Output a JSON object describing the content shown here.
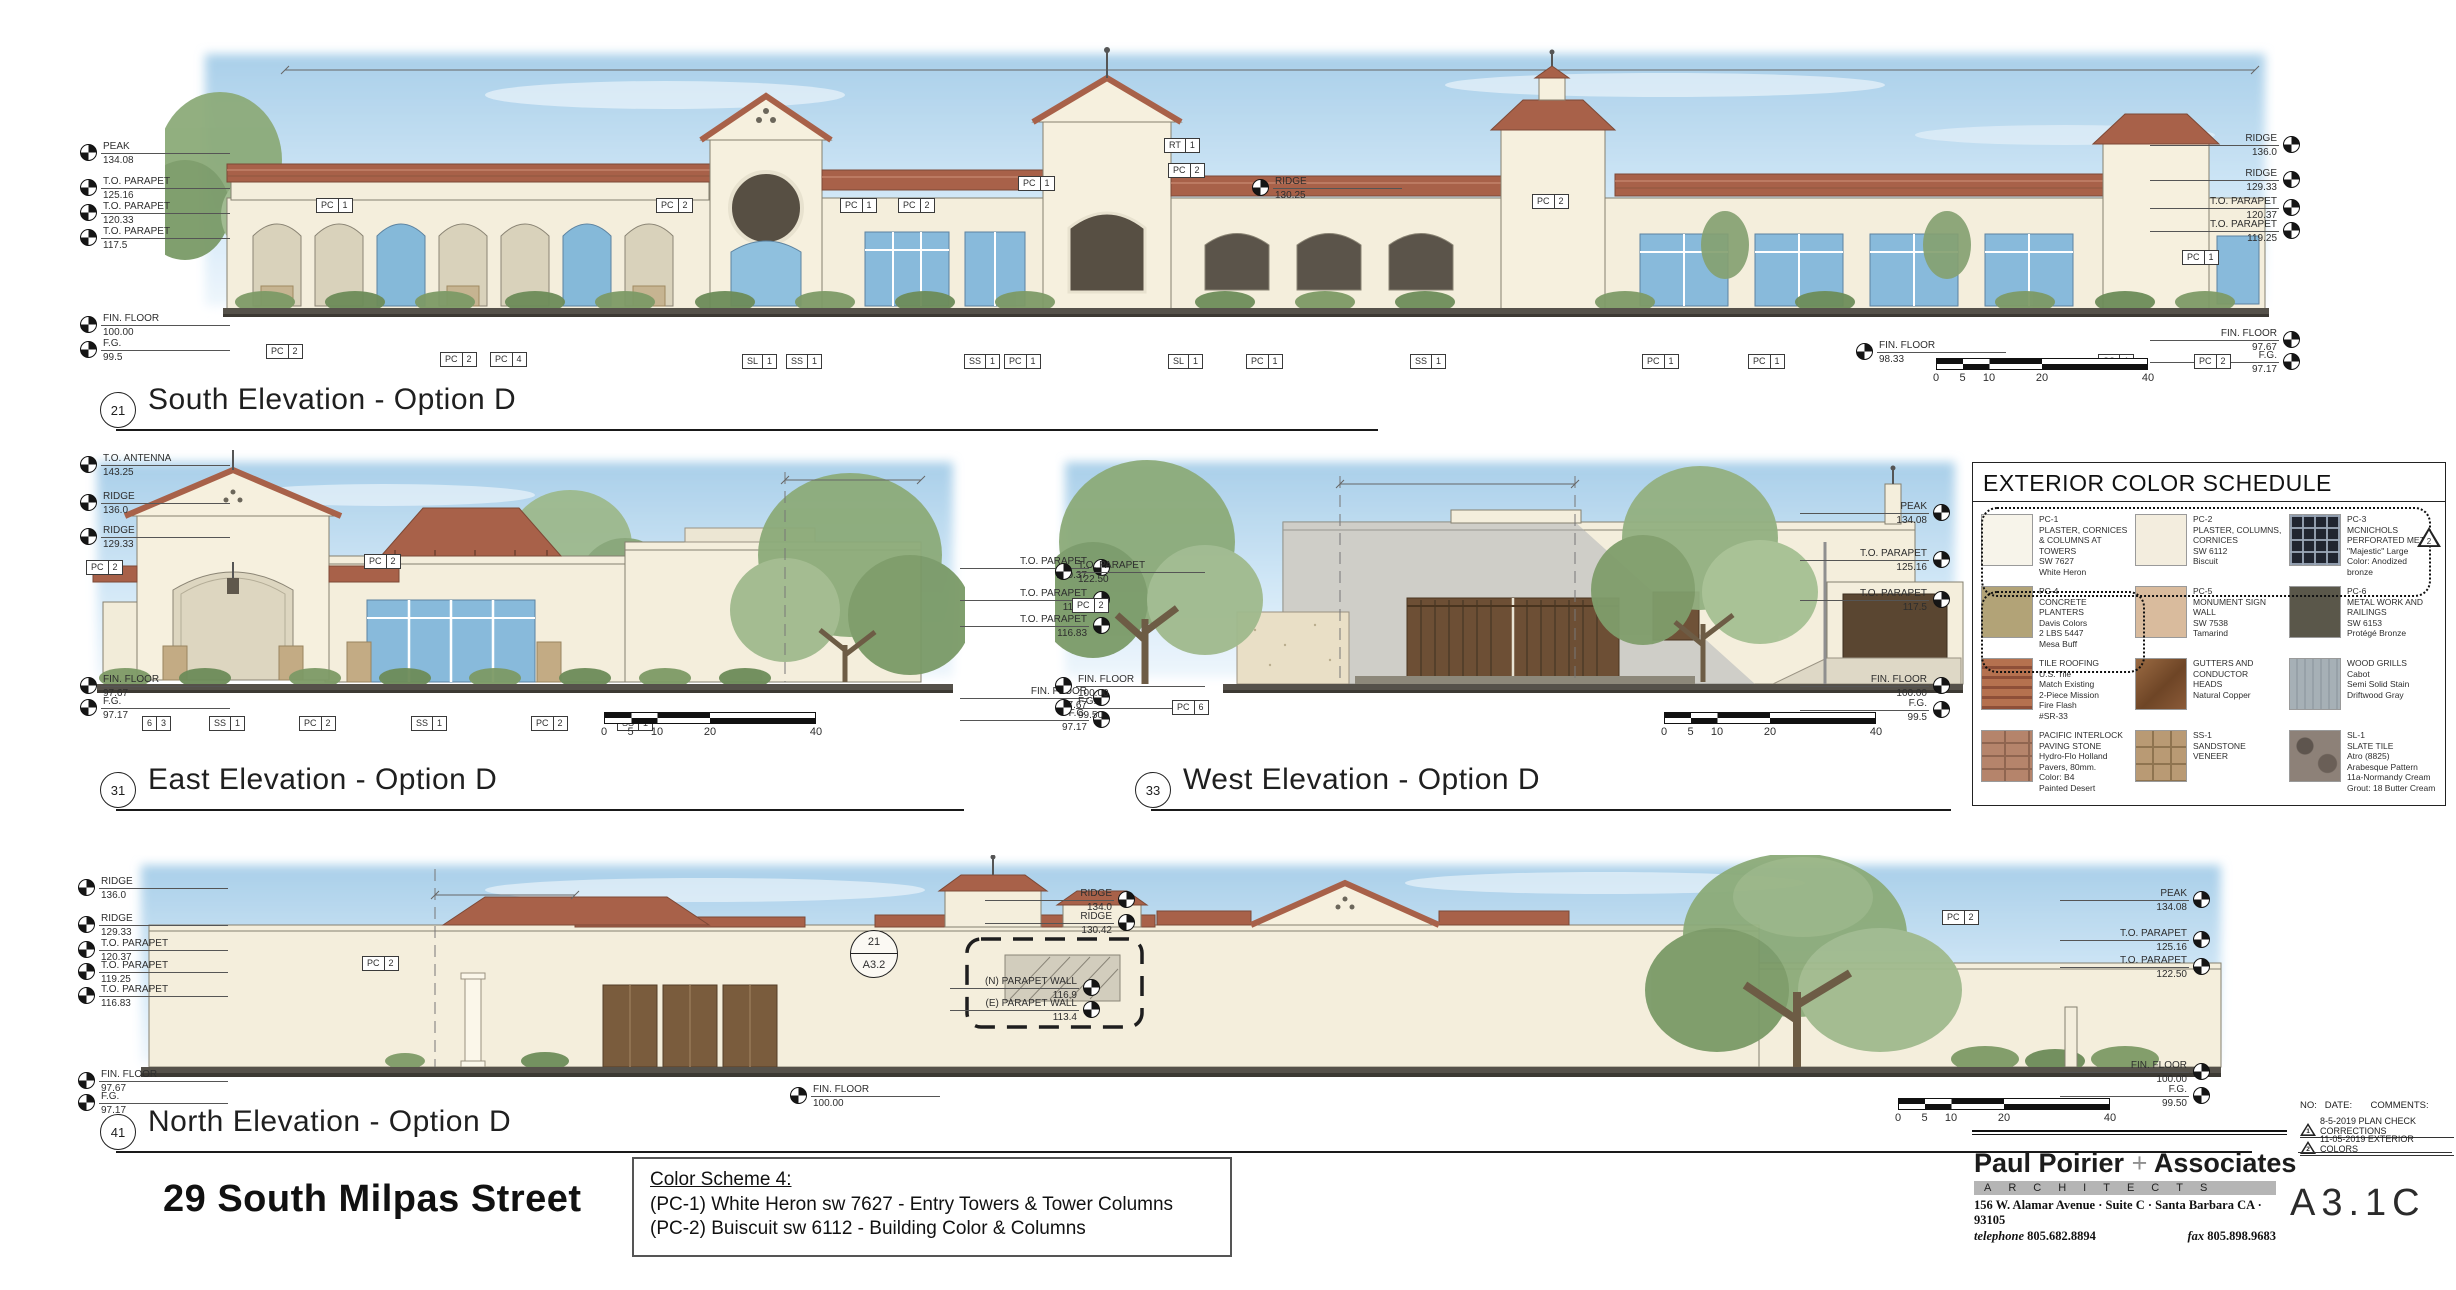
{
  "sheet": {
    "project_title": "29 South Milpas Street",
    "sheet_no": "A3.1C",
    "color_note": {
      "heading": "Color Scheme 4:",
      "line1": "(PC-1) White Heron sw 7627 - Entry Towers & Tower Columns",
      "line2": "(PC-2) Buiscuit sw 6112 - Building Color & Columns"
    },
    "firm": {
      "name_a": "Paul Poirier ",
      "plus": "+",
      "name_b": " Associates",
      "band": "ARCHITECTS",
      "address": "156 W. Alamar Avenue · Suite C · Santa Barbara CA · 93105",
      "tel_label": "telephone ",
      "tel": "805.682.8894",
      "fax_label": "fax ",
      "fax": "805.898.9683"
    },
    "revisions_header": "NO:   DATE:       COMMENTS:",
    "revisions": [
      {
        "no": "1",
        "text": "8-5-2019 PLAN CHECK CORRECTIONS",
        "x": 2300,
        "y": 1116
      },
      {
        "no": "2",
        "text": "11-05-2019 EXTERIOR COLORS",
        "x": 2300,
        "y": 1134
      }
    ],
    "schedule_delta": "2"
  },
  "titles": [
    {
      "text": "South Elevation - Option D",
      "bubble": "21",
      "x": 100,
      "y": 372,
      "lw": 1262
    },
    {
      "text": "East Elevation - Option D",
      "bubble": "31",
      "x": 100,
      "y": 752,
      "lw": 848
    },
    {
      "text": "West Elevation - Option D",
      "bubble": "33",
      "x": 1135,
      "y": 752,
      "lw": 800
    },
    {
      "text": "North Elevation - Option D",
      "bubble": "41",
      "x": 100,
      "y": 1094,
      "lw": 2136
    }
  ],
  "scalebars": [
    {
      "x": 1936,
      "y": 358,
      "t0": "0",
      "t1": "5",
      "t2": "10",
      "t3": "20",
      "t4": "40"
    },
    {
      "x": 604,
      "y": 712,
      "t0": "0",
      "t1": "5",
      "t2": "10",
      "t3": "20",
      "t4": "40"
    },
    {
      "x": 1664,
      "y": 712,
      "t0": "0",
      "t1": "5",
      "t2": "10",
      "t3": "20",
      "t4": "40"
    },
    {
      "x": 1898,
      "y": 1098,
      "t0": "0",
      "t1": "5",
      "t2": "10",
      "t3": "20",
      "t4": "40"
    }
  ],
  "detail_bubble": {
    "top": "21",
    "bottom": "A3.2"
  },
  "spots": [
    {
      "label": "PEAK",
      "value": "134.08",
      "x": 80,
      "y": 141,
      "side": "left"
    },
    {
      "label": "T.O. PARAPET",
      "value": "125.16",
      "x": 80,
      "y": 176,
      "side": "left"
    },
    {
      "label": "T.O. PARAPET",
      "value": "120.33",
      "x": 80,
      "y": 201,
      "side": "left"
    },
    {
      "label": "T.O. PARAPET",
      "value": "117.5",
      "x": 80,
      "y": 226,
      "side": "left"
    },
    {
      "label": "FIN. FLOOR",
      "value": "100.00",
      "x": 80,
      "y": 313,
      "side": "left"
    },
    {
      "label": "F.G.",
      "value": "99.5",
      "x": 80,
      "y": 338,
      "side": "left"
    },
    {
      "label": "RIDGE",
      "value": "130.25",
      "x": 1252,
      "y": 176,
      "side": "left"
    },
    {
      "label": "FIN. FLOOR",
      "value": "98.33",
      "x": 1856,
      "y": 340,
      "side": "left"
    },
    {
      "label": "RIDGE",
      "value": "136.0",
      "x": 2150,
      "y": 133,
      "side": "right"
    },
    {
      "label": "RIDGE",
      "value": "129.33",
      "x": 2150,
      "y": 168,
      "side": "right"
    },
    {
      "label": "T.O. PARAPET",
      "value": "120.37",
      "x": 2150,
      "y": 196,
      "side": "right"
    },
    {
      "label": "T.O. PARAPET",
      "value": "119.25",
      "x": 2150,
      "y": 219,
      "side": "right"
    },
    {
      "label": "FIN. FLOOR",
      "value": "97.67",
      "x": 2150,
      "y": 328,
      "side": "right"
    },
    {
      "label": "F.G.",
      "value": "97.17",
      "x": 2150,
      "y": 350,
      "side": "right"
    },
    {
      "label": "T.O. ANTENNA",
      "value": "143.25",
      "x": 80,
      "y": 453,
      "side": "left"
    },
    {
      "label": "RIDGE",
      "value": "136.0",
      "x": 80,
      "y": 491,
      "side": "left"
    },
    {
      "label": "RIDGE",
      "value": "129.33",
      "x": 80,
      "y": 525,
      "side": "left"
    },
    {
      "label": "FIN. FLOOR",
      "value": "97.67",
      "x": 80,
      "y": 674,
      "side": "left"
    },
    {
      "label": "F.G.",
      "value": "97.17",
      "x": 80,
      "y": 696,
      "side": "left"
    },
    {
      "label": "T.O. PARAPET",
      "value": "120.37",
      "x": 960,
      "y": 556,
      "side": "right"
    },
    {
      "label": "T.O. PARAPET",
      "value": "117.5",
      "x": 960,
      "y": 588,
      "side": "right"
    },
    {
      "label": "T.O. PARAPET",
      "value": "116.83",
      "x": 960,
      "y": 614,
      "side": "right"
    },
    {
      "label": "FIN. FLOOR",
      "value": "97.67",
      "x": 960,
      "y": 686,
      "side": "right"
    },
    {
      "label": "F.G.",
      "value": "97.17",
      "x": 960,
      "y": 708,
      "side": "right"
    },
    {
      "label": "T.O. PARAPET",
      "value": "122.50",
      "x": 1055,
      "y": 560,
      "side": "left"
    },
    {
      "label": "FIN. FLOOR",
      "value": "100.00",
      "x": 1055,
      "y": 674,
      "side": "left"
    },
    {
      "label": "F.G.",
      "value": "99.50",
      "x": 1055,
      "y": 696,
      "side": "left"
    },
    {
      "label": "PEAK",
      "value": "134.08",
      "x": 1800,
      "y": 501,
      "side": "right"
    },
    {
      "label": "T.O. PARAPET",
      "value": "125.16",
      "x": 1800,
      "y": 548,
      "side": "right"
    },
    {
      "label": "T.O. PARAPET",
      "value": "117.5",
      "x": 1800,
      "y": 588,
      "side": "right"
    },
    {
      "label": "FIN. FLOOR",
      "value": "100.00",
      "x": 1800,
      "y": 674,
      "side": "right"
    },
    {
      "label": "F.G.",
      "value": "99.5",
      "x": 1800,
      "y": 698,
      "side": "right"
    },
    {
      "label": "RIDGE",
      "value": "136.0",
      "x": 78,
      "y": 876,
      "side": "left"
    },
    {
      "label": "RIDGE",
      "value": "129.33",
      "x": 78,
      "y": 913,
      "side": "left"
    },
    {
      "label": "T.O. PARAPET",
      "value": "120.37",
      "x": 78,
      "y": 938,
      "side": "left"
    },
    {
      "label": "T.O. PARAPET",
      "value": "119.25",
      "x": 78,
      "y": 960,
      "side": "left"
    },
    {
      "label": "T.O. PARAPET",
      "value": "116.83",
      "x": 78,
      "y": 984,
      "side": "left"
    },
    {
      "label": "FIN. FLOOR",
      "value": "97.67",
      "x": 78,
      "y": 1069,
      "side": "left"
    },
    {
      "label": "F.G.",
      "value": "97.17",
      "x": 78,
      "y": 1091,
      "side": "left"
    },
    {
      "label": "FIN. FLOOR",
      "value": "100.00",
      "x": 790,
      "y": 1084,
      "side": "left"
    },
    {
      "label": "RIDGE",
      "value": "134.0",
      "x": 985,
      "y": 888,
      "side": "right"
    },
    {
      "label": "RIDGE",
      "value": "130.42",
      "x": 985,
      "y": 911,
      "side": "right"
    },
    {
      "label": "(N) PARAPET WALL",
      "value": "116.9",
      "x": 950,
      "y": 976,
      "side": "right"
    },
    {
      "label": "(E) PARAPET WALL",
      "value": "113.4",
      "x": 950,
      "y": 998,
      "side": "right"
    },
    {
      "label": "PEAK",
      "value": "134.08",
      "x": 2060,
      "y": 888,
      "side": "right"
    },
    {
      "label": "T.O. PARAPET",
      "value": "125.16",
      "x": 2060,
      "y": 928,
      "side": "right"
    },
    {
      "label": "T.O. PARAPET",
      "value": "122.50",
      "x": 2060,
      "y": 955,
      "side": "right"
    },
    {
      "label": "FIN. FLOOR",
      "value": "100.00",
      "x": 2060,
      "y": 1060,
      "side": "right"
    },
    {
      "label": "F.G.",
      "value": "99.50",
      "x": 2060,
      "y": 1084,
      "side": "right"
    }
  ],
  "tags": [
    {
      "a": "PC",
      "b": "1",
      "x": 316,
      "y": 198
    },
    {
      "a": "PC",
      "b": "2",
      "x": 656,
      "y": 198
    },
    {
      "a": "PC",
      "b": "1",
      "x": 840,
      "y": 198
    },
    {
      "a": "PC",
      "b": "2",
      "x": 898,
      "y": 198
    },
    {
      "a": "PC",
      "b": "1",
      "x": 1018,
      "y": 176
    },
    {
      "a": "RT",
      "b": "1",
      "x": 1164,
      "y": 138
    },
    {
      "a": "PC",
      "b": "2",
      "x": 1168,
      "y": 163
    },
    {
      "a": "PC",
      "b": "2",
      "x": 1532,
      "y": 194
    },
    {
      "a": "PC",
      "b": "1",
      "x": 2182,
      "y": 250
    },
    {
      "a": "PC",
      "b": "2",
      "x": 266,
      "y": 344
    },
    {
      "a": "PC",
      "b": "2",
      "x": 440,
      "y": 352
    },
    {
      "a": "PC",
      "b": "4",
      "x": 490,
      "y": 352
    },
    {
      "a": "SL",
      "b": "1",
      "x": 742,
      "y": 354
    },
    {
      "a": "SS",
      "b": "1",
      "x": 786,
      "y": 354
    },
    {
      "a": "SS",
      "b": "1",
      "x": 964,
      "y": 354
    },
    {
      "a": "PC",
      "b": "1",
      "x": 1004,
      "y": 354
    },
    {
      "a": "SL",
      "b": "1",
      "x": 1168,
      "y": 354
    },
    {
      "a": "PC",
      "b": "1",
      "x": 1246,
      "y": 354
    },
    {
      "a": "SS",
      "b": "1",
      "x": 1410,
      "y": 354
    },
    {
      "a": "PC",
      "b": "1",
      "x": 1642,
      "y": 354
    },
    {
      "a": "PC",
      "b": "1",
      "x": 1748,
      "y": 354
    },
    {
      "a": "SS",
      "b": "1",
      "x": 2098,
      "y": 354
    },
    {
      "a": "PC",
      "b": "2",
      "x": 2194,
      "y": 354
    },
    {
      "a": "PC",
      "b": "2",
      "x": 86,
      "y": 560
    },
    {
      "a": "PC",
      "b": "2",
      "x": 364,
      "y": 554
    },
    {
      "a": "6",
      "b": "3",
      "x": 142,
      "y": 716
    },
    {
      "a": "SS",
      "b": "1",
      "x": 209,
      "y": 716
    },
    {
      "a": "PC",
      "b": "2",
      "x": 299,
      "y": 716
    },
    {
      "a": "SS",
      "b": "1",
      "x": 411,
      "y": 716
    },
    {
      "a": "PC",
      "b": "2",
      "x": 531,
      "y": 716
    },
    {
      "a": "SS",
      "b": "1",
      "x": 617,
      "y": 716
    },
    {
      "a": "PC",
      "b": "2",
      "x": 1072,
      "y": 598
    },
    {
      "a": "PC",
      "b": "6",
      "x": 1172,
      "y": 700
    },
    {
      "a": "PC",
      "b": "2",
      "x": 362,
      "y": 956
    },
    {
      "a": "PC",
      "b": "2",
      "x": 1942,
      "y": 910
    }
  ],
  "notes": [
    {
      "text": "LEASABLE SPACE\n223'-0\"",
      "x": 778,
      "y": 52,
      "w": 120,
      "align": "center"
    },
    {
      "text": "(E) ROOF LEVEL",
      "x": 205,
      "y": 135
    },
    {
      "text": "(N) PARAPET\nCORNICE",
      "x": 170,
      "y": 168
    },
    {
      "text": "20'x20' PARAPETS W/\nDECORATIVE PINNEAPLE",
      "x": 398,
      "y": 181
    },
    {
      "text": "(N) PARAPET\nCORNICE",
      "x": 404,
      "y": 212
    },
    {
      "text": "(E) ROOF SCREENS",
      "x": 540,
      "y": 194
    },
    {
      "text": "(N) PARAPET CORNICE\n& SCALLOP TRIM",
      "x": 702,
      "y": 196
    },
    {
      "text": "WOOD OUTRIGGERS",
      "x": 1006,
      "y": 153
    },
    {
      "text": "WOOD RAFTER TAILS",
      "x": 1540,
      "y": 212
    },
    {
      "text": "(N) 48\" HIGH CMU\nWALL W/ STUCCO\nFINISH BEYOND",
      "x": 164,
      "y": 264
    },
    {
      "text": "WALL MOUNTED\nLANTERN LIGHT\nFIXTURES",
      "x": 380,
      "y": 342
    },
    {
      "text": "STONE VENEER\nO/ (E) CURB,\nSIDES & TOP",
      "x": 538,
      "y": 342
    },
    {
      "text": "(N) CONCRETE PLANTERS\nBY KORNEGAY DESIGN\nSEE DET 44 & 45",
      "x": 604,
      "y": 342
    },
    {
      "text": "DECORATIVE METAL\nGRILLE AT ARCH",
      "x": 681,
      "y": 345
    },
    {
      "text": "WALL MOUNTED\nLANTERN LIGHT\nFIXTURES",
      "x": 868,
      "y": 342
    },
    {
      "text": "DECORATIVE METAL\nGRILLE AT ARCH",
      "x": 1082,
      "y": 345
    },
    {
      "text": "WALL MOUNTED\nLANTERN LIGHT\nFIXTURES",
      "x": 1284,
      "y": 342
    },
    {
      "text": "WALL MOUNTED\nLANTERN LIGHT\nFIXTURES",
      "x": 1455,
      "y": 342
    },
    {
      "text": "5'-4\"",
      "x": 2240,
      "y": 280
    },
    {
      "text": "26'-6\"\nSETBACK",
      "x": 742,
      "y": 470,
      "w": 70,
      "align": "center"
    },
    {
      "text": "16'-0\"\nSETBACK",
      "x": 1148,
      "y": 516,
      "w": 70,
      "align": "center"
    },
    {
      "text": "(N) DOORS",
      "x": 1146,
      "y": 544
    },
    {
      "text": "(E) 6' HIGH\nCMU WALL",
      "x": 1082,
      "y": 636
    },
    {
      "text": "(N) 6' HIGH CMU\nWALL W/ WD.\nGATES",
      "x": 1084,
      "y": 715
    },
    {
      "text": "(N) TRASH\nCOMPACTOR\nCHUTE",
      "x": 1230,
      "y": 698
    },
    {
      "text": "(N) RAMP",
      "x": 1303,
      "y": 720
    },
    {
      "text": "(N) ROLL-UP\nDOORS",
      "x": 1406,
      "y": 716
    },
    {
      "text": "7'-0\" HIGH AFF\nCMU WALL\n6'-0\" HIGH AFF\nCMU WALL",
      "x": 1342,
      "y": 526
    },
    {
      "text": "(N) COLUMNS\nCAPITAL, TYP.",
      "x": 1856,
      "y": 620
    },
    {
      "text": "(E) METAL ENCLOSURES TO REMAIN",
      "x": 1745,
      "y": 697,
      "w": 160
    },
    {
      "text": "P.L.",
      "x": 188,
      "y": 918
    },
    {
      "text": "10'-0\"\nSETBACK",
      "x": 210,
      "y": 926,
      "w": 70,
      "align": "center"
    },
    {
      "text": "AREA OF\nWORK",
      "x": 856,
      "y": 906
    },
    {
      "text": "(E) ROOF SCREENS",
      "x": 1788,
      "y": 916
    },
    {
      "text": "7'-0\" HIGH\nWALL AFF",
      "x": 2110,
      "y": 982
    },
    {
      "text": "6'-8\" HIGH\nWALL AFF",
      "x": 2110,
      "y": 1026
    },
    {
      "text": "(N) 6' HIGH CMU WALL\n@ ADJACENT PROPERTY",
      "x": 670,
      "y": 1096
    },
    {
      "text": "(N) PARAPET WALL",
      "x": 893,
      "y": 1098
    }
  ],
  "color_schedule": {
    "title": "EXTERIOR COLOR SCHEDULE",
    "items": [
      {
        "text": "PC-1\nPLASTER, CORNICES\n& COLUMNS AT\nTOWERS\nSW 7627\nWhite Heron",
        "cls": "sw-pc1"
      },
      {
        "text": "PC-2\nPLASTER, COLUMNS,\nCORNICES\nSW 6112\nBiscuit",
        "cls": "sw-pc2"
      },
      {
        "text": "PC-3\nMCNICHOLS\nPERFORATED METAL\n\"Majestic\" Large\nColor: Anodized\nbronze",
        "cls": "sw-pc3"
      },
      {
        "text": "PC-4\nCONCRETE PLANTERS\nDavis Colors\n2 LBS 5447\nMesa Buff",
        "cls": "sw-pc4"
      },
      {
        "text": "PC-5\nMONUMENT SIGN\nWALL\nSW 7538\nTamarind",
        "cls": "sw-pc5"
      },
      {
        "text": "PC-6\nMETAL WORK AND\nRAILINGS\nSW 6153\nProtégé Bronze",
        "cls": "sw-pc6"
      },
      {
        "text": "TILE ROOFING\nU.S. Tile\nMatch Existing\n2-Piece Mission\nFire Flash\n#SR-33",
        "cls": "sw-tile"
      },
      {
        "text": "GUTTERS AND\nCONDUCTOR\nHEADS\nNatural Copper",
        "cls": "sw-copper"
      },
      {
        "text": "WOOD GRILLS\nCabot\nSemi Solid Stain\nDriftwood Gray",
        "cls": "sw-wood"
      },
      {
        "text": "PACIFIC INTERLOCK\nPAVING STONE\nHydro-Flo Holland\nPavers, 80mm.\nColor: B4\nPainted Desert",
        "cls": "sw-paver"
      },
      {
        "text": "SS-1\nSANDSTONE\nVENEER",
        "cls": "sw-sand"
      },
      {
        "text": "SL-1\nSLATE TILE\nAtro (8825)\nArabesque Pattern\n11a-Normandy Cream\nGrout: 18 Butter Cream",
        "cls": "sw-slate"
      }
    ]
  }
}
